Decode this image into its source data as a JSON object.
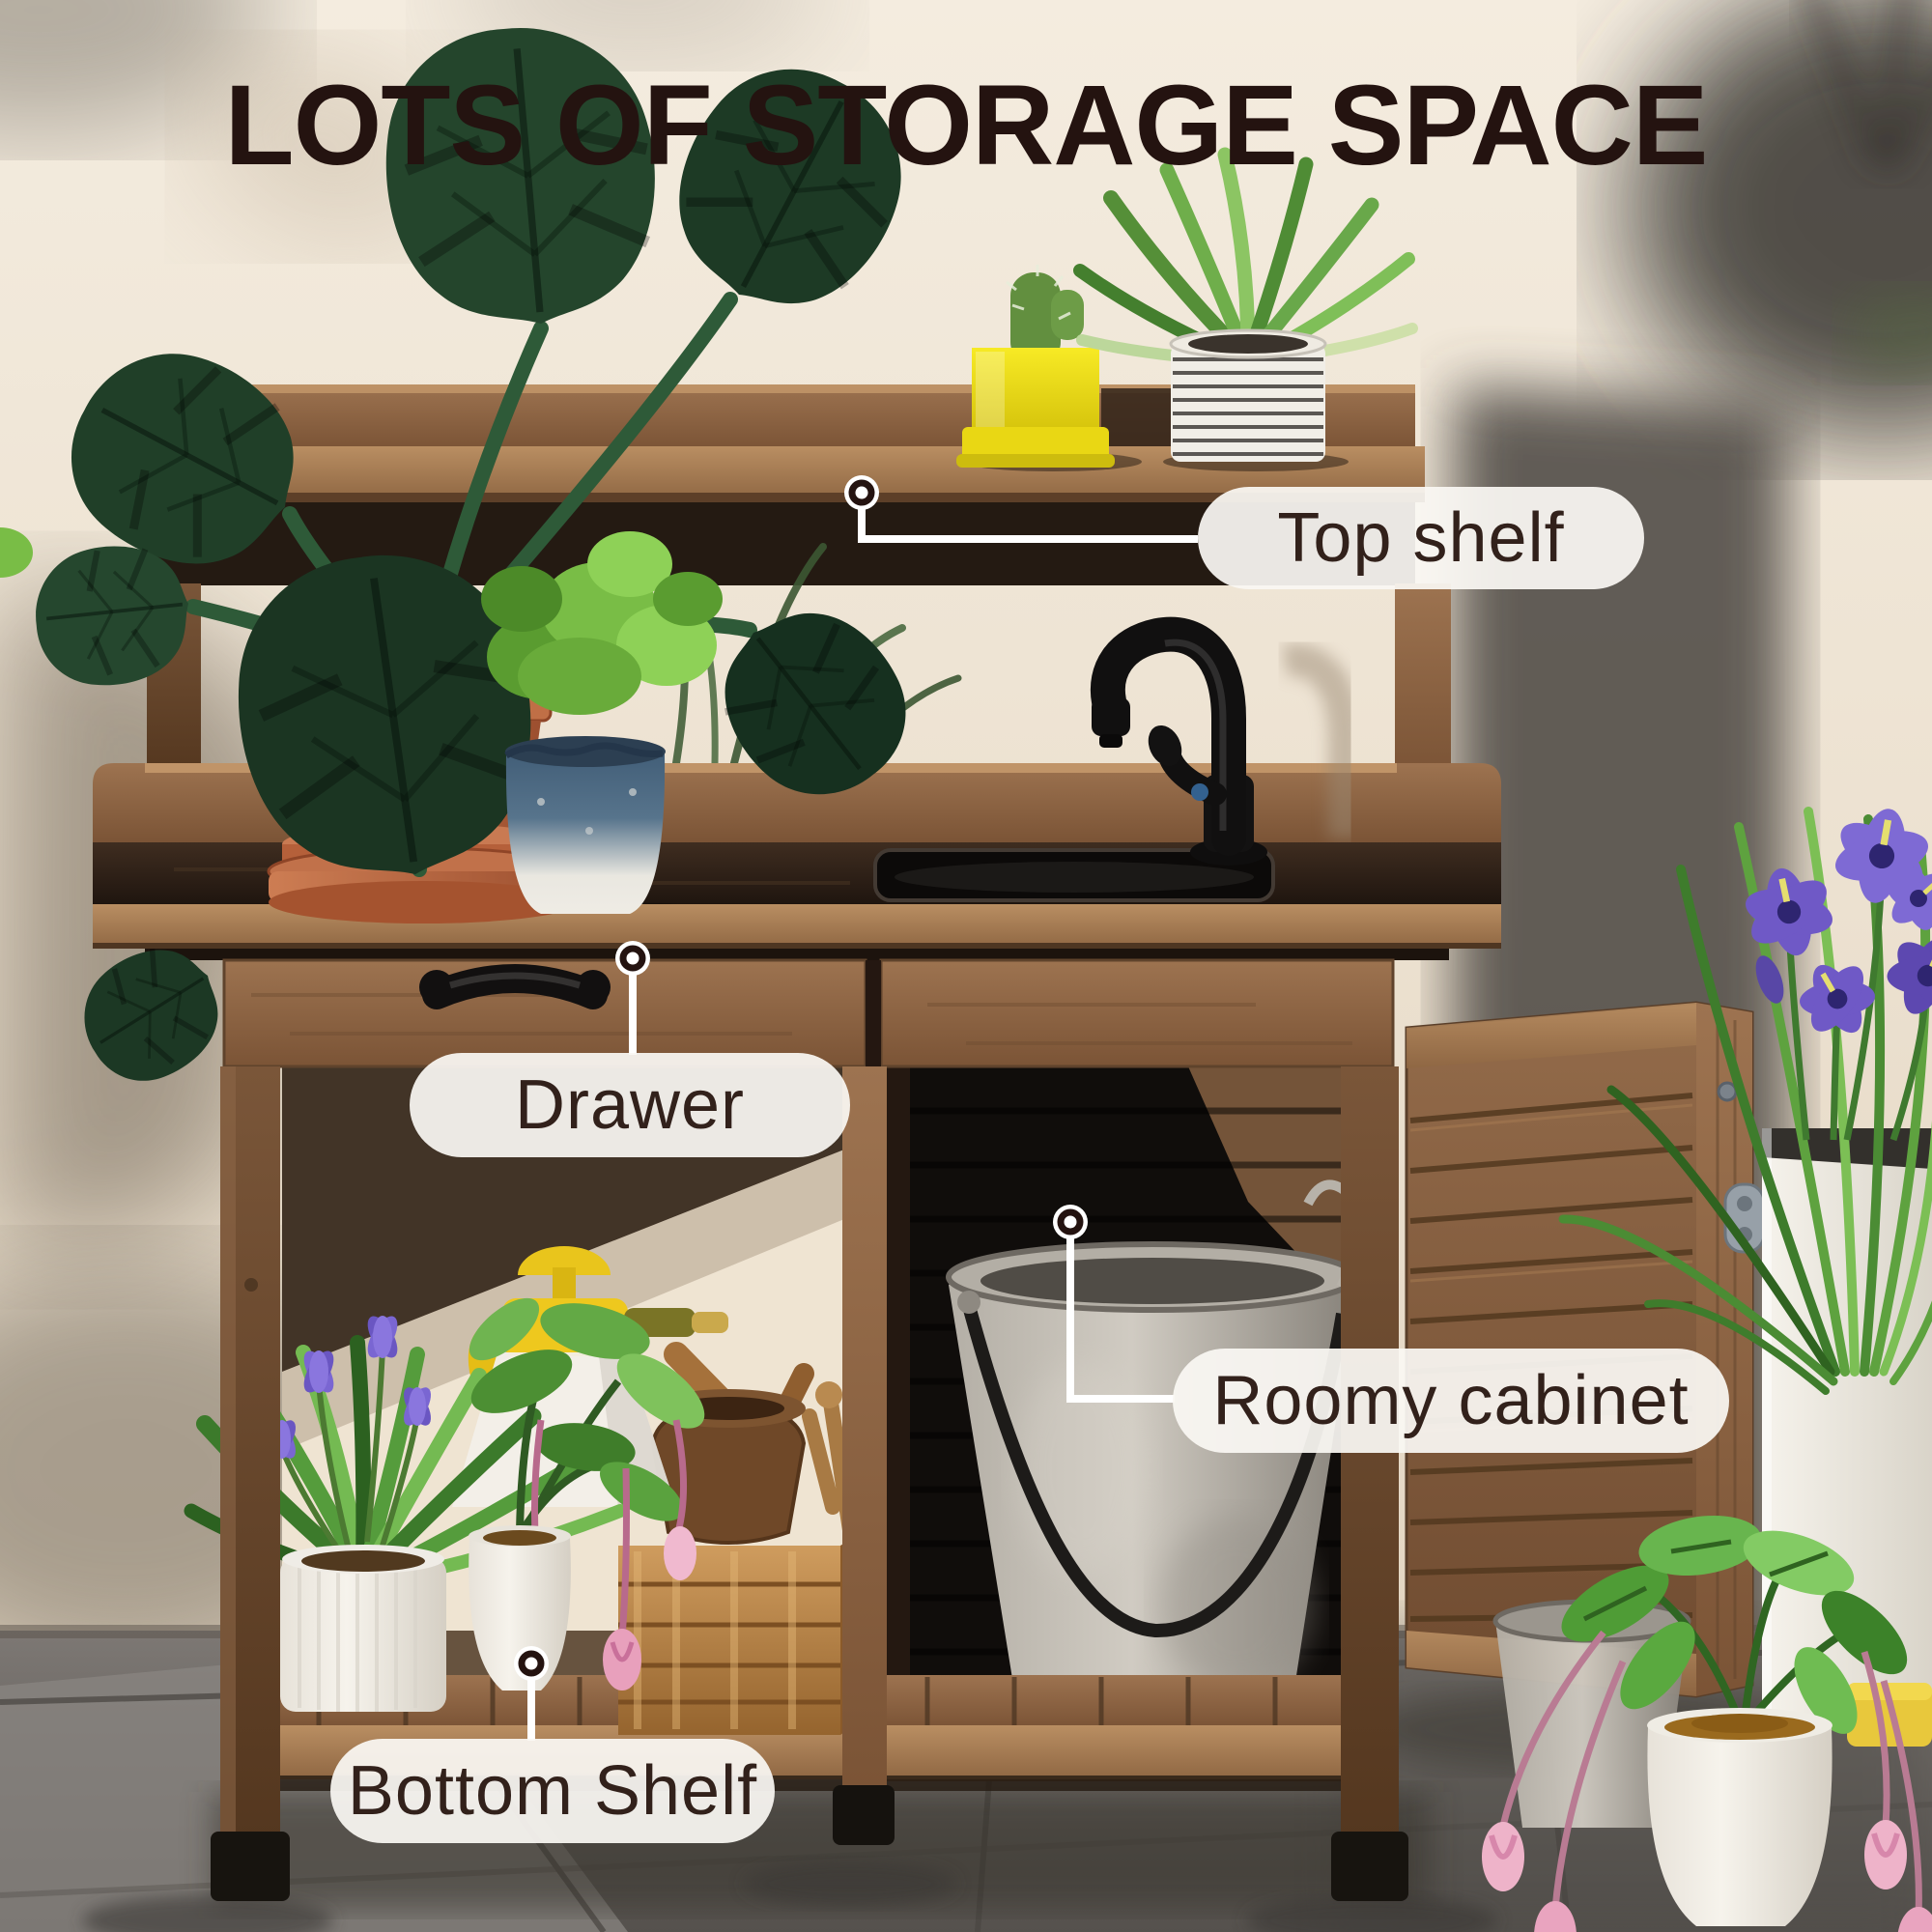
{
  "title": "LOTS OF STORAGE SPACE",
  "callouts": [
    {
      "id": "top-shelf",
      "label": "Top shelf"
    },
    {
      "id": "drawer",
      "label": "Drawer"
    },
    {
      "id": "roomy-cabinet",
      "label": "Roomy cabinet"
    },
    {
      "id": "bottom-shelf",
      "label": "Bottom Shelf"
    }
  ],
  "colors": {
    "title_text": "#241310",
    "callout_text": "#32211b",
    "callout_pill_bg": "#f8f5f1",
    "leader_line": "#ffffff",
    "callout_dot_ring": "#241310",
    "wood": "#8a6345",
    "wall": "#eadfd0",
    "floor": "#6e6a67",
    "yellow_pot": "#f2e21c",
    "terracotta_pot": "#c1714a",
    "iris_purple": "#6f59c6"
  }
}
